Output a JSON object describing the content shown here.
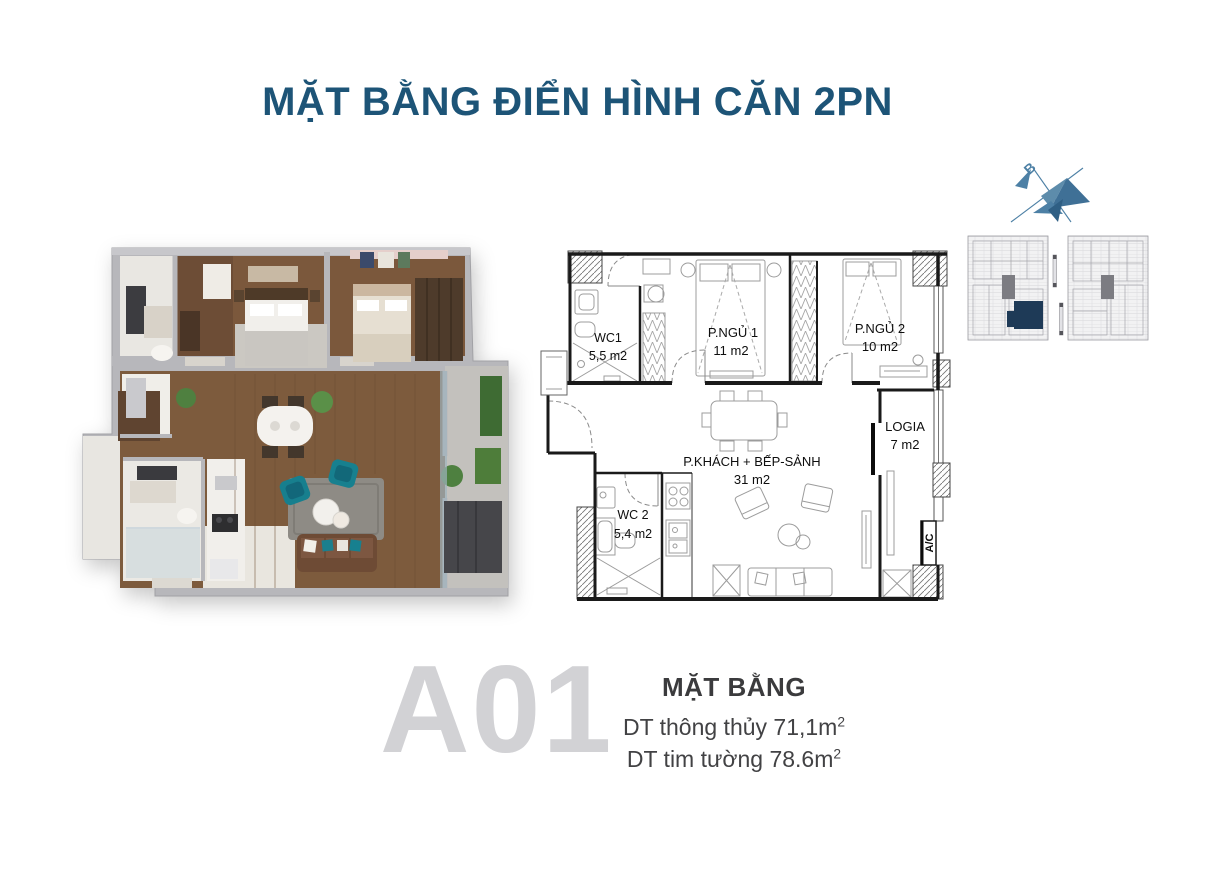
{
  "header": {
    "title": "MẶT BẰNG ĐIỂN HÌNH CĂN 2PN",
    "title_color": "#1d5477"
  },
  "compass": {
    "north_label": "B"
  },
  "floor_plan": {
    "rooms": [
      {
        "name": "WC1",
        "area": "5,5 m2"
      },
      {
        "name": "P.NGỦ 1",
        "area": "11 m2"
      },
      {
        "name": "P.NGỦ 2",
        "area": "10 m2"
      },
      {
        "name": "P.KHÁCH + BẾP-SẢNH",
        "area": "31 m2"
      },
      {
        "name": "WC 2",
        "area": "5,4 m2"
      },
      {
        "name": "LOGIA",
        "area": "7 m2"
      }
    ],
    "ac_label": "A/C"
  },
  "unit_info": {
    "code": "A01",
    "section_title": "MẶT BẰNG",
    "net_area": "DT thông thủy 71,1m",
    "net_area_sup": "2",
    "gross_area": "DT tim tường 78.6m",
    "gross_area_sup": "2"
  },
  "colors": {
    "accent_blue": "#4d80a5",
    "highlight_navy": "#1e3a57",
    "unit_code_gray": "#d2d2d5"
  }
}
